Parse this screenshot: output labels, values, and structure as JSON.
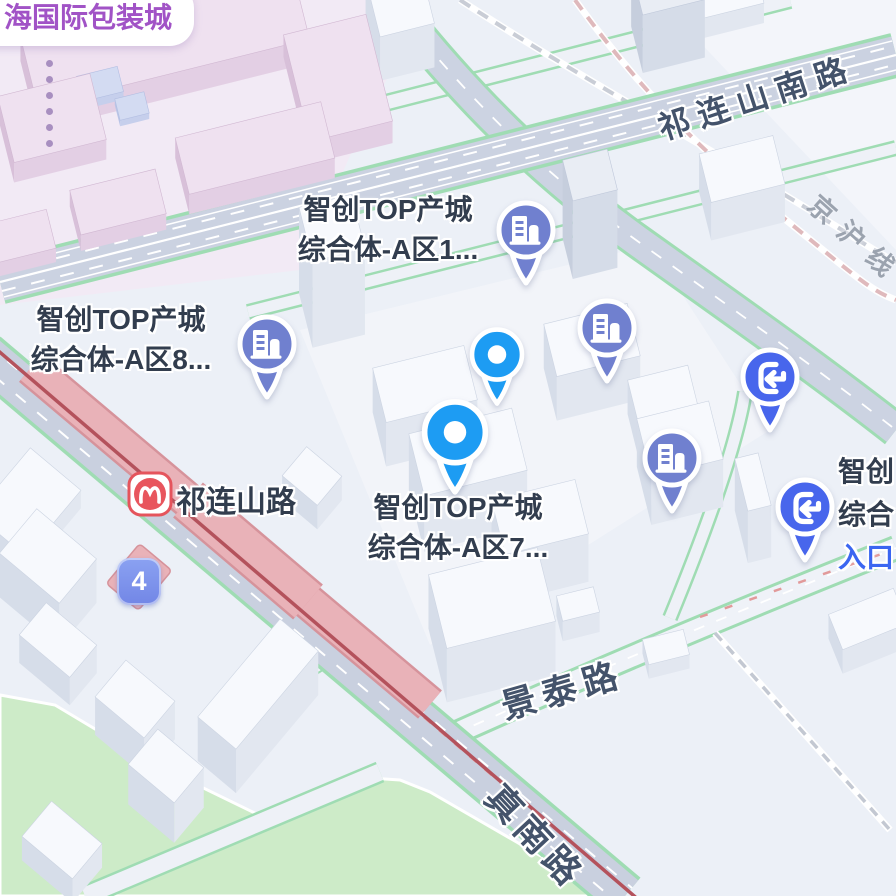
{
  "colors": {
    "poi_text": "#323d4e",
    "road_text": "#44536b",
    "railway_text": "#9ba3af",
    "entrance_text": "#3b66f1",
    "landmark_text": "#a153c6",
    "pin_building": "#7080cf",
    "pin_entrance": "#4866ec",
    "pin_dot": "#1d9cf3",
    "metro_red": "#e5545c",
    "shield_blue": "#7d93ea",
    "road_edge_green": "#9fdcb3",
    "park_green": "#cdebc8",
    "viaduct_pink": "#e9b2b8"
  },
  "landmark": {
    "label": "海国际包装城"
  },
  "roads": {
    "qilianshan_south": "祁连山南路",
    "jinghu_railway": "京沪线",
    "jingtai": "景泰路",
    "zhennan": "真南路"
  },
  "metro": {
    "station_name": "祁连山路"
  },
  "shield": {
    "number": "4"
  },
  "pois": {
    "a1": {
      "line1": "智创TOP产城",
      "line2": "综合体-A区1..."
    },
    "a8": {
      "line1": "智创TOP产城",
      "line2": "综合体-A区8..."
    },
    "a7": {
      "line1": "智创TOP产城",
      "line2": "综合体-A区7..."
    },
    "edge": {
      "line1": "智创",
      "line2": "综合",
      "entrance": "入口"
    }
  }
}
